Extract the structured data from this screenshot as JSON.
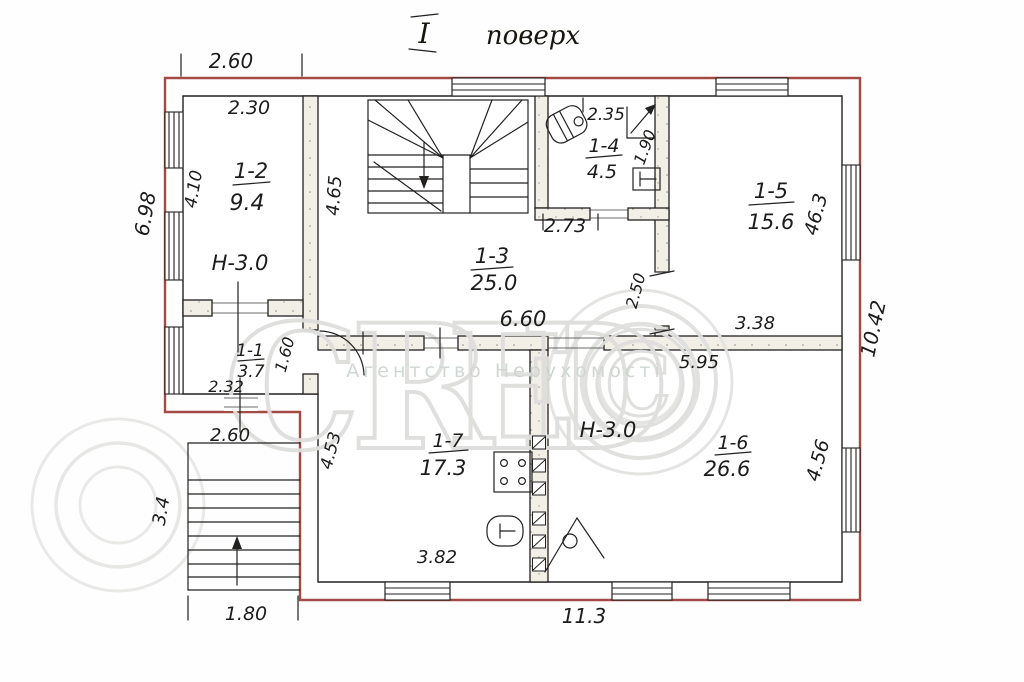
{
  "title": {
    "roman": "І",
    "word": "поверх"
  },
  "rooms": {
    "r12": {
      "num": "1-2",
      "area": "9.4"
    },
    "r11": {
      "num": "1-1",
      "area": "3.7"
    },
    "r13": {
      "num": "1-3",
      "area": "25.0"
    },
    "r14": {
      "num": "1-4",
      "area": "4.5"
    },
    "r15": {
      "num": "1-5",
      "area": "15.6"
    },
    "r16": {
      "num": "1-6",
      "area": "26.6"
    },
    "r17": {
      "num": "1-7",
      "area": "17.3"
    }
  },
  "heights": {
    "left": "Н-3.0",
    "right": "Н-3.0"
  },
  "dims": {
    "d260_top": "2.60",
    "d230": "2.30",
    "d410": "4.10",
    "d698": "6.98",
    "d465": "4.65",
    "d235": "2.35",
    "d190": "1.90",
    "d273": "2.73",
    "d463": "46.3",
    "d1042": "10.42",
    "d250": "2.50",
    "d660": "6.60",
    "d338": "3.38",
    "d595": "5.95",
    "d160": "1.60",
    "d232": "2.32",
    "d260_porch": "2.60",
    "d453": "4.53",
    "d34": "3.4",
    "d180": "1.80",
    "d382": "3.82",
    "d113": "11.3",
    "d456": "4.56"
  },
  "watermark": {
    "letters": [
      "C",
      "R",
      "E",
      "D"
    ],
    "mark": "©",
    "subtitle": "Агентство Нерухомості"
  },
  "colors": {
    "outline_red": "#a34a44",
    "ink": "#222120",
    "wall_fill": "#f2efe7",
    "watermark_gray": "#dededc"
  }
}
